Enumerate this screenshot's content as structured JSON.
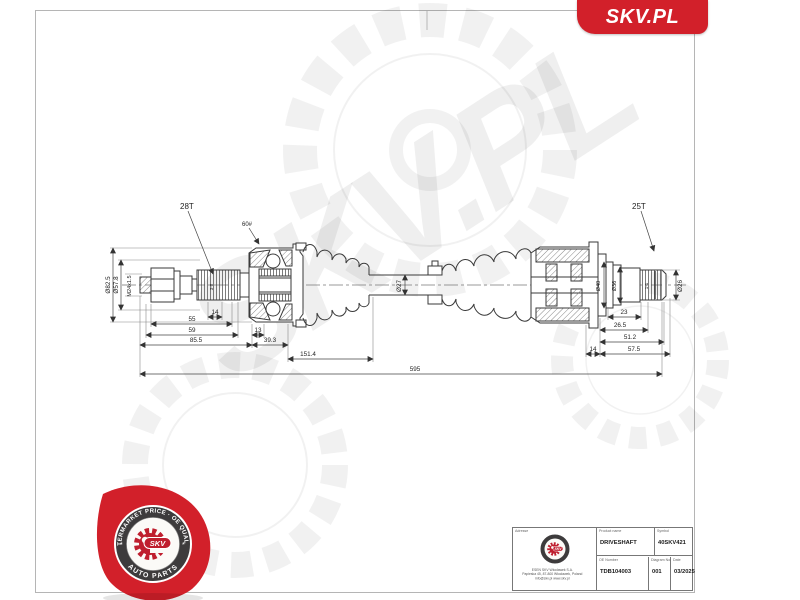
{
  "banner": {
    "brand": "SKV.PL"
  },
  "watermark": {
    "text": "SKV.PL"
  },
  "drawing": {
    "labels": {
      "left_spline_teeth": "28T",
      "right_spline_teeth": "25T",
      "hardness_note": "60#",
      "left_spline_note": "3-8",
      "right_spline_note": "1-1"
    },
    "dims": {
      "d82": "Ø82.5",
      "d57": "Ø57.8",
      "thread": "M24x1.5",
      "l14a": "14",
      "l55": "55",
      "l59": "59",
      "l13": "13",
      "l85": "85.5",
      "l39": "39.3",
      "l151": "151.4",
      "d27": "Ø27",
      "d40": "Ø40",
      "d36": "Ø36",
      "d26": "Ø26",
      "l23": "23",
      "l26_5": "26.5",
      "l51": "51.2",
      "l14b": "14",
      "l57": "57.5",
      "overall": "595"
    }
  },
  "badge": {
    "arc_top": "AFTERMARKET PRICE · OE QUALITY",
    "arc_bottom": "AUTO PARTS",
    "center": "SKV",
    "star": "*"
  },
  "title_block": {
    "address_label": "Adresse",
    "address1": "ESEN SKV Włocławek S.A.",
    "address2": "Papieska 45, 87-800 Włocławek, Poland",
    "address3": "info@skv.pl  www.skv.pl",
    "product_name_label": "Product name",
    "product_name": "DRIVESHAFT",
    "symbol_label": "Symbol",
    "symbol": "40SKV421",
    "oe_number_label": "OE Number",
    "oe_number": "TDB104003",
    "diagram_no_label": "Diagram No.",
    "diagram_no": "001",
    "date_label": "Date",
    "date": "03/2025"
  },
  "colors": {
    "accent_red": "#d2202a",
    "ring_dark": "#3d3b3c",
    "line": "#333333"
  }
}
